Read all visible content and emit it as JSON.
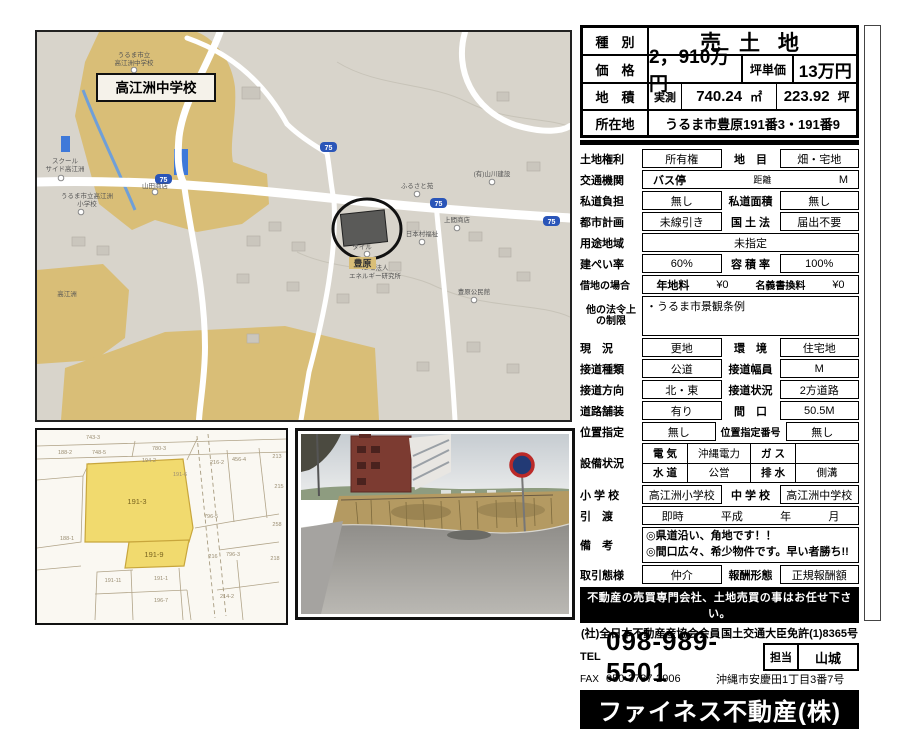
{
  "colors": {
    "map_bg": "#d8d4cb",
    "school_ground": "#d9be77",
    "pool_blue": "#3f79d9",
    "shield_blue": "#2a55b8",
    "parcel_yellow": "#f1da6e",
    "road_white": "#ffffff"
  },
  "summary": {
    "type_label": "種　別",
    "type_value": "売 土 地",
    "price_label": "価　格",
    "price_value": "2，910万円",
    "unit_label": "坪単価",
    "unit_value": "13万円",
    "area_label": "地　積",
    "area_mode": "実測",
    "area_sqm": "740.24",
    "sqm_unit": "㎡",
    "area_tsubo": "223.92",
    "tsubo_unit": "坪",
    "address_label": "所在地",
    "address_value": "うるま市豊原191番3・191番9"
  },
  "details": {
    "r01": {
      "label": "土地権利",
      "c1": "所有権",
      "l2": "地　目",
      "c2": "畑・宅地"
    },
    "r02": {
      "label": "交通機関",
      "p1": "バス停",
      "p2": "距離",
      "p3": "M"
    },
    "r03": {
      "label": "私道負担",
      "c1": "無し",
      "l2": "私道面積",
      "c2": "無し"
    },
    "r04": {
      "label": "都市計画",
      "c1": "未線引き",
      "l2": "国 土 法",
      "c2": "届出不要"
    },
    "r05": {
      "label": "用途地域",
      "c1": "未指定"
    },
    "r06": {
      "label": "建ぺい率",
      "c1": "60%",
      "l2": "容 積 率",
      "c2": "100%"
    },
    "r07": {
      "label": "借地の場合",
      "p1": "年地料",
      "v1": "¥0",
      "p2": "名義書換料",
      "v2": "¥0"
    },
    "r08": {
      "label1": "他の法令上",
      "label2": "の制限",
      "value": "・うるま市景観条例"
    },
    "r09": {
      "label": "現　況",
      "c1": "更地",
      "l2": "環　境",
      "c2": "住宅地"
    },
    "r10": {
      "label": "接道種類",
      "c1": "公道",
      "l2": "接道幅員",
      "c2": "M"
    },
    "r11": {
      "label": "接道方向",
      "c1": "北・東",
      "l2": "接道状況",
      "c2": "2方道路"
    },
    "r12": {
      "label": "道路舗装",
      "c1": "有り",
      "l2": "間　口",
      "c2": "50.5M"
    },
    "r13": {
      "label": "位置指定",
      "c1": "無し",
      "l2": "位置指定番号",
      "c2": "無し"
    },
    "r14": {
      "label": "設備状況",
      "u11": "電 気",
      "u12": "沖縄電力",
      "u13": "ガ ス",
      "u14": "",
      "u21": "水 道",
      "u22": "公営",
      "u23": "排 水",
      "u24": "側溝"
    },
    "r15": {
      "label": "小 学 校",
      "c1": "高江洲小学校",
      "l2": "中 学 校",
      "c2": "高江洲中学校"
    },
    "r16": {
      "label": "引　渡",
      "p1": "即時",
      "p2": "平成",
      "p3": "年",
      "p4": "月"
    },
    "r17": {
      "label": "備　考",
      "line1": "◎県道沿い、角地です！！",
      "line2": "◎間口広々、希少物件です。早い者勝ち!!"
    },
    "r18": {
      "label": "取引態様",
      "c1": "仲介",
      "l2": "報酬形態",
      "c2": "正規報酬額"
    }
  },
  "footer": {
    "banner": "不動産の売買専門会社、土地売買の事はお任せ下さい。",
    "membership_left": "(社)全日本不動産産協会会員",
    "membership_right": "国土交通大臣免許(1)8365号",
    "tel_label": "TEL",
    "tel_number": "098-989-5501",
    "tanto_label": "担当",
    "tanto_value": "山城",
    "fax_label": "FAX",
    "fax_number": "050-3737-2906",
    "office_address": "沖縄市安慶田1丁目3番7号",
    "company": "ファイネス不動産(株)"
  },
  "map": {
    "school_box": "高江洲中学校",
    "area_label": "豊原",
    "shield": "75",
    "pois": [
      {
        "l1": "うるま市立",
        "l2": "高江洲中学校"
      },
      {
        "l1": "スクール",
        "l2": "サイド高江洲"
      },
      {
        "l1": "うるま市立高江洲",
        "l2": "小学校"
      },
      {
        "l1": "山田商店",
        "l2": ""
      },
      {
        "l1": "ふるさと苑",
        "l2": ""
      },
      {
        "l1": "(有)山川建設",
        "l2": ""
      },
      {
        "l1": "上間商店",
        "l2": ""
      },
      {
        "l1": "日本村福祉",
        "l2": ""
      },
      {
        "l1": "NPO法人",
        "l2": "エネルギー研究所"
      },
      {
        "l1": "豊原公民館",
        "l2": ""
      },
      {
        "l1": "高江洲",
        "l2": ""
      },
      {
        "l1": "タイル",
        "l2": ""
      }
    ]
  },
  "cadastral": {
    "parcel_main": "191-3",
    "parcel_sub": "191-9",
    "parcels": [
      "743-3",
      "188-2",
      "748-5",
      "780-3",
      "194-2",
      "191-6",
      "216-2",
      "456-4",
      "213",
      "215",
      "796-5",
      "258",
      "188-1",
      "191-11",
      "191-1",
      "196-7",
      "216",
      "796-3",
      "214-2",
      "218"
    ]
  }
}
